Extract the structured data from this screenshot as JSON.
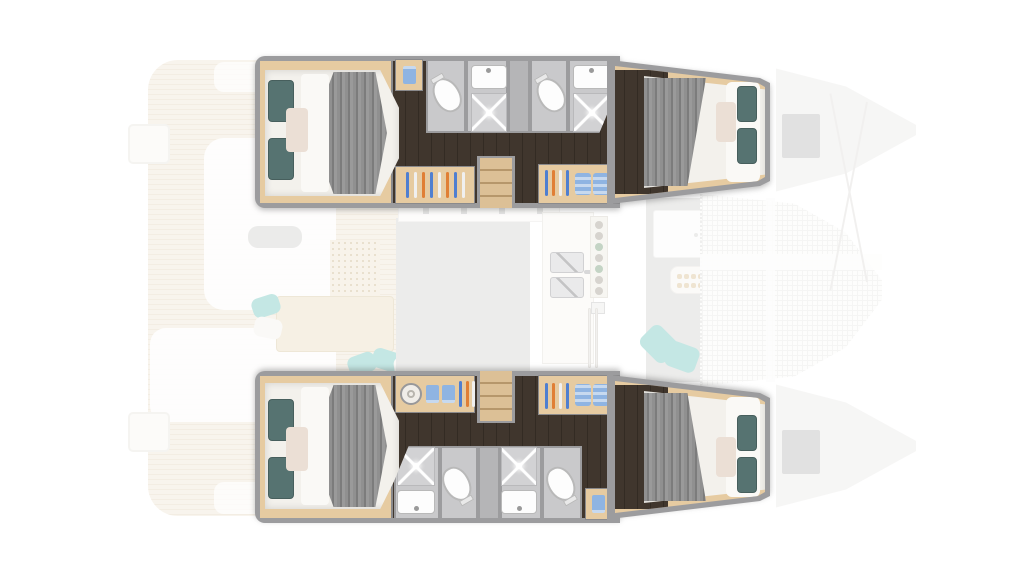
{
  "page": {
    "background": "#ffffff",
    "description": "Top-down floor plan of a sailing catamaran, bow to the right. Four highlighted en-suite double cabins in the two hulls; salon, galley, cockpit and bow trampoline shown faded."
  },
  "inventory": {
    "hulls": 2,
    "cabins": 4,
    "double_beds": 4,
    "bathrooms": 4,
    "toilets": 4,
    "showers": 4,
    "washbasins": 4,
    "wardrobes": 4,
    "companionway_stairs": 2,
    "washing_machines": 1,
    "galley_sink_bowls": 2,
    "stove_burners": 7,
    "cockpit_tables": 1,
    "salon_seats": 1,
    "trampolines": 1,
    "deck_hatches": 2,
    "swim_platforms": 2
  },
  "colors": {
    "background": "#ffffff",
    "hull_wall": "#9c9c9e",
    "hull_wall_dark": "#8a8a8c",
    "floor_dark": "#40362d",
    "floor_dark_line": "#332b23",
    "wood": "#e6cba1",
    "stairs_light": "#dcc096",
    "stairs_dark": "#b6976b",
    "mattress": "#f3f1ec",
    "sheet": "#faf9f6",
    "blanket_a": "#909090",
    "blanket_b": "#7c7c7c",
    "blanket_c": "#9a9a9a",
    "pillow_teal": "#567371",
    "pillow_teal_edge": "#475f5d",
    "pillow_blush": "#ebdfd5",
    "bath_floor": "#c9c9cb",
    "bath_divider": "#b5b5b7",
    "shower_pan": "#d2d2d4",
    "porcelain": "#fdfdfd",
    "fixture_line": "#b9b9b9",
    "hanger_blue": "#4f7fd0",
    "hanger_orange": "#e07f35",
    "hanger_white": "#f0f0f0",
    "clothes_blue": "#8fb4e2",
    "clothes_blue_light": "#c7d9ef",
    "teak_a": "#f3ebdd",
    "teak_b": "#e9deca",
    "ghost_white": "#ffffff",
    "ghost_floor_gray": "#dcdbda",
    "ghost_bench": "#d9d9d7",
    "table_wood": "#efe3cc",
    "mat_bg": "#f2e9d8",
    "mat_dot": "#d6c4a2",
    "ghost_pillow_teal": "#8fd2cc",
    "ghost_pillow_white": "#f7f5f1",
    "steel": "#d7d7d9",
    "steel_dark": "#a9a9ab",
    "tramp_line": "#ededeb",
    "bow_fill": "#efeeec",
    "hatch_gray": "#c7c7c7",
    "stay_line": "#e6e4e1",
    "burner_gray": "#b3aea4",
    "burner_green": "#8fae91",
    "dot_tan": "#e2cda9",
    "cabinet_white": "#fcfbf9"
  }
}
